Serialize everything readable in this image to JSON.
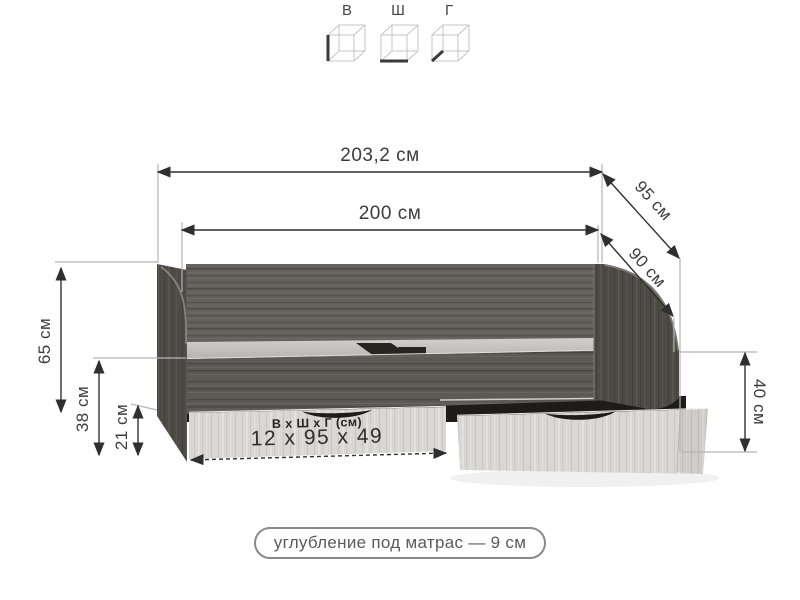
{
  "legend": {
    "items": [
      {
        "id": "height",
        "label": "В"
      },
      {
        "id": "width",
        "label": "Ш"
      },
      {
        "id": "depth",
        "label": "Г"
      }
    ]
  },
  "dimensions": {
    "total_length": "203,2 см",
    "mattress_length": "200 см",
    "total_depth": "95 см",
    "mattress_depth": "90 см",
    "left_height": "65 см",
    "base_height": "38 см",
    "drawer_front_height": "21 см",
    "right_height": "40 см",
    "drawer_inner": {
      "title": "В х Ш х Г (см)",
      "value": "12 х 95 х 49"
    }
  },
  "note": "углубление под матрас — 9 см",
  "colors": {
    "dimension_line": "#2f2f2f",
    "extension_line": "#b5b5b5",
    "dark_wood": "#605e5b",
    "side_panel_wood": "#4e4b47",
    "light_wood": "#d8d7d4",
    "shadow": "#1d1c1b",
    "label_text": "#3c3c3c",
    "note_text": "#5a5a5a",
    "note_border": "#8a8a8a"
  }
}
